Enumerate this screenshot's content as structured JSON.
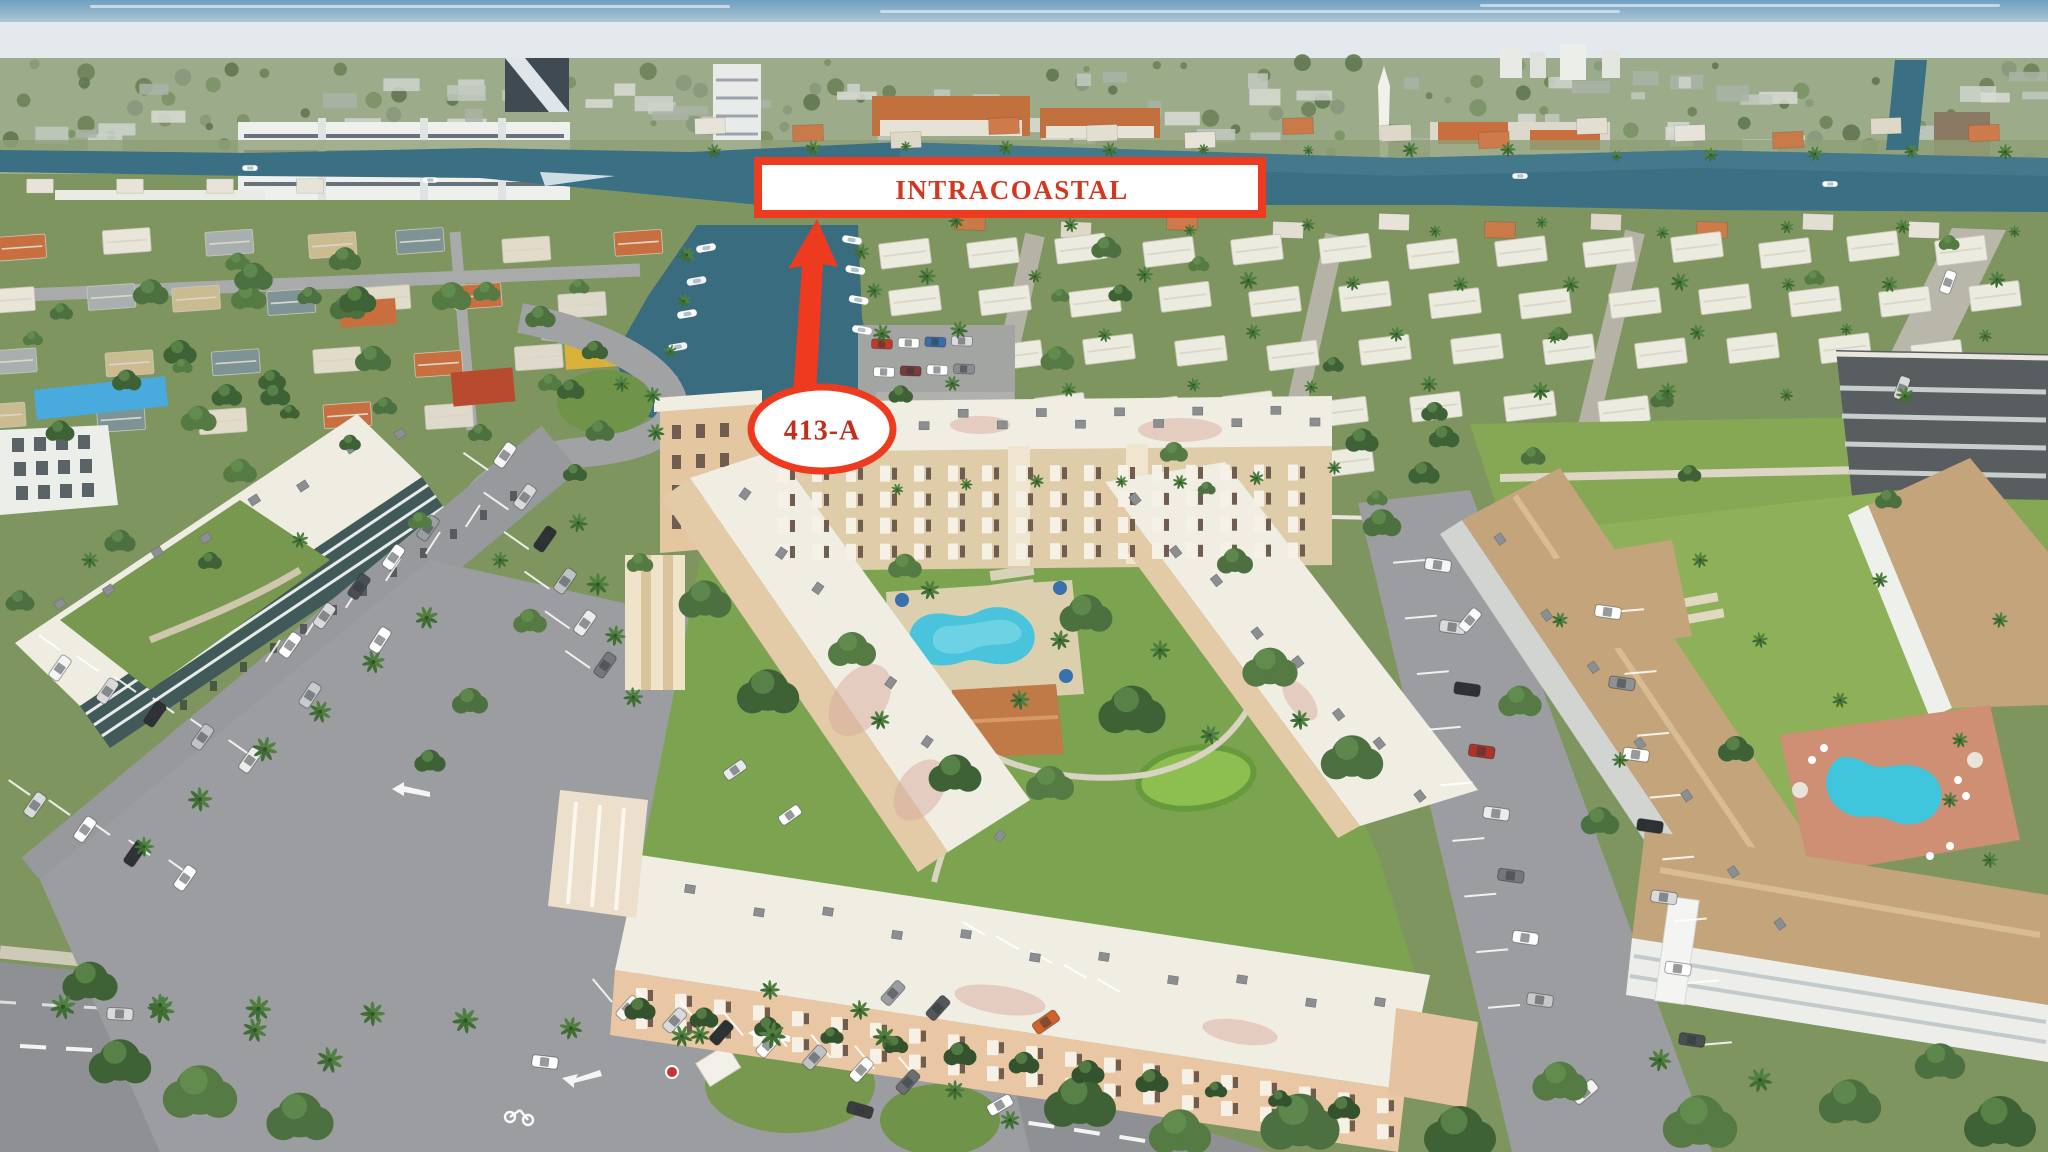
{
  "photo": {
    "description": "Aerial drone view of a waterfront condominium community beside the Intracoastal Waterway, with canals, marinas, swimming pools, parking lots and palm-lined streets",
    "annotations": {
      "waterway_label": "INTRACOASTAL",
      "unit_label": "413-A"
    },
    "colors": {
      "annotation_red": "#ee3a1e",
      "waterway_label_text": "#d2371f",
      "unit_label_text": "#c22d1c",
      "water_teal": "#3b6f84",
      "pool_cyan": "#49c4dc",
      "lawn_green": "#7ca450",
      "roof_white": "#f0ede3",
      "building_tan": "#e2cba6",
      "roof_tan": "#c4a47b",
      "asphalt_gray": "#9b9da0"
    }
  }
}
